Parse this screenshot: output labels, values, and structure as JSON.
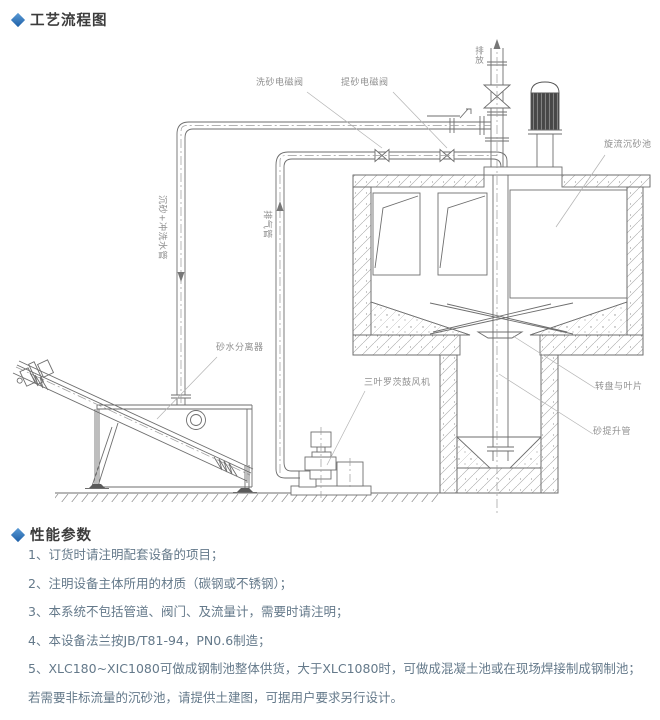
{
  "sections": {
    "flow": {
      "title": "工艺流程图"
    },
    "performance": {
      "title": "性能参数",
      "items": [
        "1、订货时请注明配套设备的项目；",
        "2、注明设备主体所用的材质（碳钢或不锈钢）；",
        "3、本系统不包括管道、阀门、及流量计，需要时请注明；",
        "4、本设备法兰按JB/T81-94，PN0.6制造；",
        "5、XLC180~XIC1080可做成钢制池整体供货，大于XLC1080时，可做成混凝土池或在现场焊接制成钢制池；",
        "若需要非标流量的沉砂池，请提供土建图，可据用户要求另行设计。"
      ]
    }
  },
  "diagram": {
    "labels": {
      "wash_valve": "洗砂电磁阀",
      "lift_valve": "提砂电磁阀",
      "discharge": "排放",
      "cyclone_tank": "旋流沉砂池",
      "sand_wash_pipe": "沉砂+冲洗水管",
      "air_pipe": "排气管",
      "separator": "砂水分离器",
      "blower": "三叶罗茨鼓风机",
      "disc_blades": "转盘与叶片",
      "sand_lift_pipe": "砂提升管"
    },
    "colors": {
      "line": "#6e6e6e",
      "label": "#8f8f8f",
      "accent": "#1d5fa7",
      "list_text": "#64798a"
    }
  }
}
